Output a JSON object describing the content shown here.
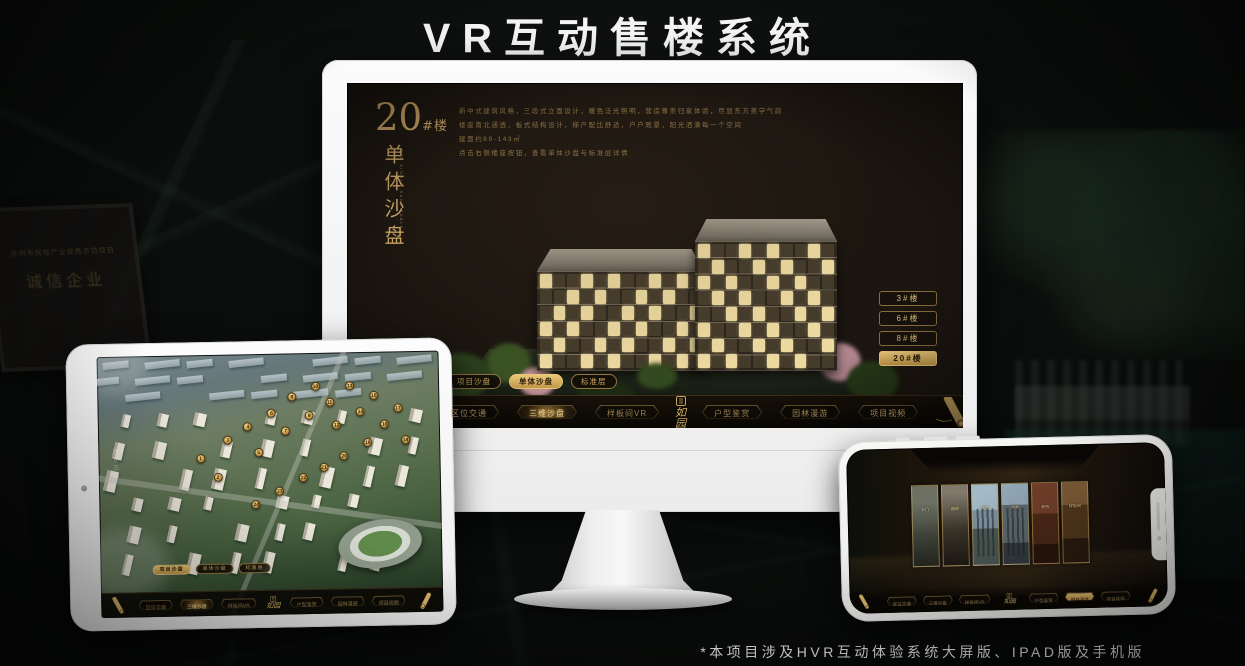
{
  "page": {
    "title": "VR互动售楼系统",
    "footer_note": "*本项目涉及HVR互动体验系统大屏版、IPAD版及手机版"
  },
  "colors": {
    "gold": "#d2ab62",
    "gold_dark": "#8a6a2e",
    "screen_bg": "#1c1610",
    "title_white": "#f4f4f4"
  },
  "logo": {
    "name": "如园"
  },
  "background": {
    "certificate_line1": "苏州市房地产业优秀示范项目",
    "certificate_line2": "诚信企业"
  },
  "monitor": {
    "panel": {
      "block_number": "20",
      "block_unit": "#楼",
      "subtitle": "单体沙盘",
      "subtitle_en": "THE SINGLE SAND TABLE",
      "description_lines": [
        "新中式建筑风格，三段式立面设计，暖色泛光照明，营造尊崇归家体验，尽显东方美学气韵",
        "楼座南北通透，板式结构设计，梯户配比舒适，户户观景，阳光洒满每一个空间",
        "建面约89-143㎡",
        "点击右侧楼座按钮，查看单体沙盘与标准层详情"
      ]
    },
    "floor_buttons": [
      {
        "label": "3#楼",
        "selected": false
      },
      {
        "label": "6#楼",
        "selected": false
      },
      {
        "label": "8#楼",
        "selected": false
      },
      {
        "label": "20#楼",
        "selected": true
      }
    ],
    "sub_tabs": [
      {
        "label": "项目沙盘",
        "selected": false
      },
      {
        "label": "单体沙盘",
        "selected": true
      },
      {
        "label": "标准层",
        "selected": false
      }
    ],
    "nav_left": [
      {
        "label": "区位交通",
        "selected": false
      },
      {
        "label": "三维沙盘",
        "selected": true
      },
      {
        "label": "样板间VR",
        "selected": false
      }
    ],
    "nav_right": [
      {
        "label": "户型鉴赏",
        "selected": false
      },
      {
        "label": "园林漫游",
        "selected": false
      },
      {
        "label": "项目视频",
        "selected": false
      }
    ]
  },
  "tablet": {
    "road_label": "西环三路",
    "sub_tabs": [
      {
        "label": "项目沙盘",
        "selected": true
      },
      {
        "label": "单体沙盘",
        "selected": false
      },
      {
        "label": "标准层",
        "selected": false
      }
    ],
    "nav_left": [
      {
        "label": "区位交通",
        "selected": false
      },
      {
        "label": "三维沙盘",
        "selected": true
      },
      {
        "label": "样板间VR",
        "selected": false
      }
    ],
    "nav_right": [
      {
        "label": "户型鉴赏",
        "selected": false
      },
      {
        "label": "园林漫游",
        "selected": false
      },
      {
        "label": "项目视频",
        "selected": false
      }
    ],
    "markers": [
      {
        "n": "1",
        "x": 30,
        "y": 40
      },
      {
        "n": "2",
        "x": 35,
        "y": 47
      },
      {
        "n": "3",
        "x": 38,
        "y": 33
      },
      {
        "n": "4",
        "x": 44,
        "y": 28
      },
      {
        "n": "5",
        "x": 47,
        "y": 38
      },
      {
        "n": "6",
        "x": 51,
        "y": 23
      },
      {
        "n": "7",
        "x": 55,
        "y": 30
      },
      {
        "n": "8",
        "x": 57,
        "y": 17
      },
      {
        "n": "9",
        "x": 62,
        "y": 24
      },
      {
        "n": "10",
        "x": 64,
        "y": 13
      },
      {
        "n": "11",
        "x": 68,
        "y": 19
      },
      {
        "n": "12",
        "x": 70,
        "y": 28
      },
      {
        "n": "13",
        "x": 74,
        "y": 13
      },
      {
        "n": "14",
        "x": 77,
        "y": 23
      },
      {
        "n": "15",
        "x": 81,
        "y": 17
      },
      {
        "n": "16",
        "x": 84,
        "y": 28
      },
      {
        "n": "17",
        "x": 88,
        "y": 22
      },
      {
        "n": "18",
        "x": 90,
        "y": 34
      },
      {
        "n": "19",
        "x": 79,
        "y": 35
      },
      {
        "n": "20",
        "x": 72,
        "y": 40
      },
      {
        "n": "21",
        "x": 66,
        "y": 44
      },
      {
        "n": "22",
        "x": 60,
        "y": 48
      },
      {
        "n": "23",
        "x": 53,
        "y": 53
      },
      {
        "n": "24",
        "x": 46,
        "y": 58
      }
    ]
  },
  "phone": {
    "cards": [
      {
        "label": "大门"
      },
      {
        "label": "园林"
      },
      {
        "label": "楼座"
      },
      {
        "label": "实景"
      },
      {
        "label": "会所"
      },
      {
        "label": "样板间"
      }
    ],
    "nav_left": [
      {
        "label": "区位交通",
        "selected": false
      },
      {
        "label": "三维沙盘",
        "selected": false
      },
      {
        "label": "样板间VR",
        "selected": false
      }
    ],
    "nav_right": [
      {
        "label": "户型鉴赏",
        "selected": false
      },
      {
        "label": "园林漫游",
        "selected": true
      },
      {
        "label": "项目视频",
        "selected": false
      }
    ]
  }
}
